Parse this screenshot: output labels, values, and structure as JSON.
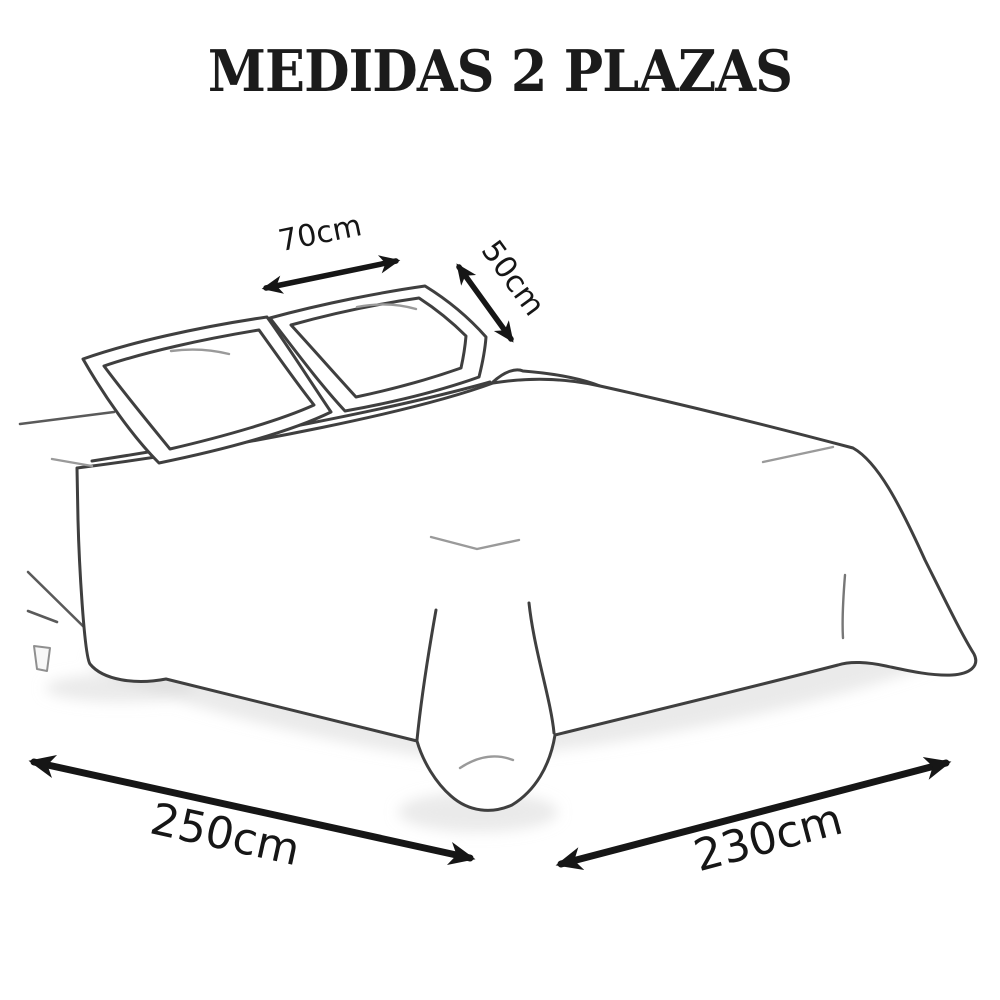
{
  "title": "MEDIDAS 2 PLAZAS",
  "measurements": {
    "pillow_width": {
      "label": "70cm"
    },
    "pillow_depth": {
      "label": "50cm"
    },
    "bed_length": {
      "label": "250cm"
    },
    "bed_width": {
      "label": "230cm"
    }
  },
  "colors": {
    "background": "#ffffff",
    "illustration_line": "#3f3f3f",
    "crease_line": "#9a9a9a",
    "arrow": "#161616",
    "title_text": "#1b1b1b",
    "floor_shadow": "#d9d9d9"
  }
}
